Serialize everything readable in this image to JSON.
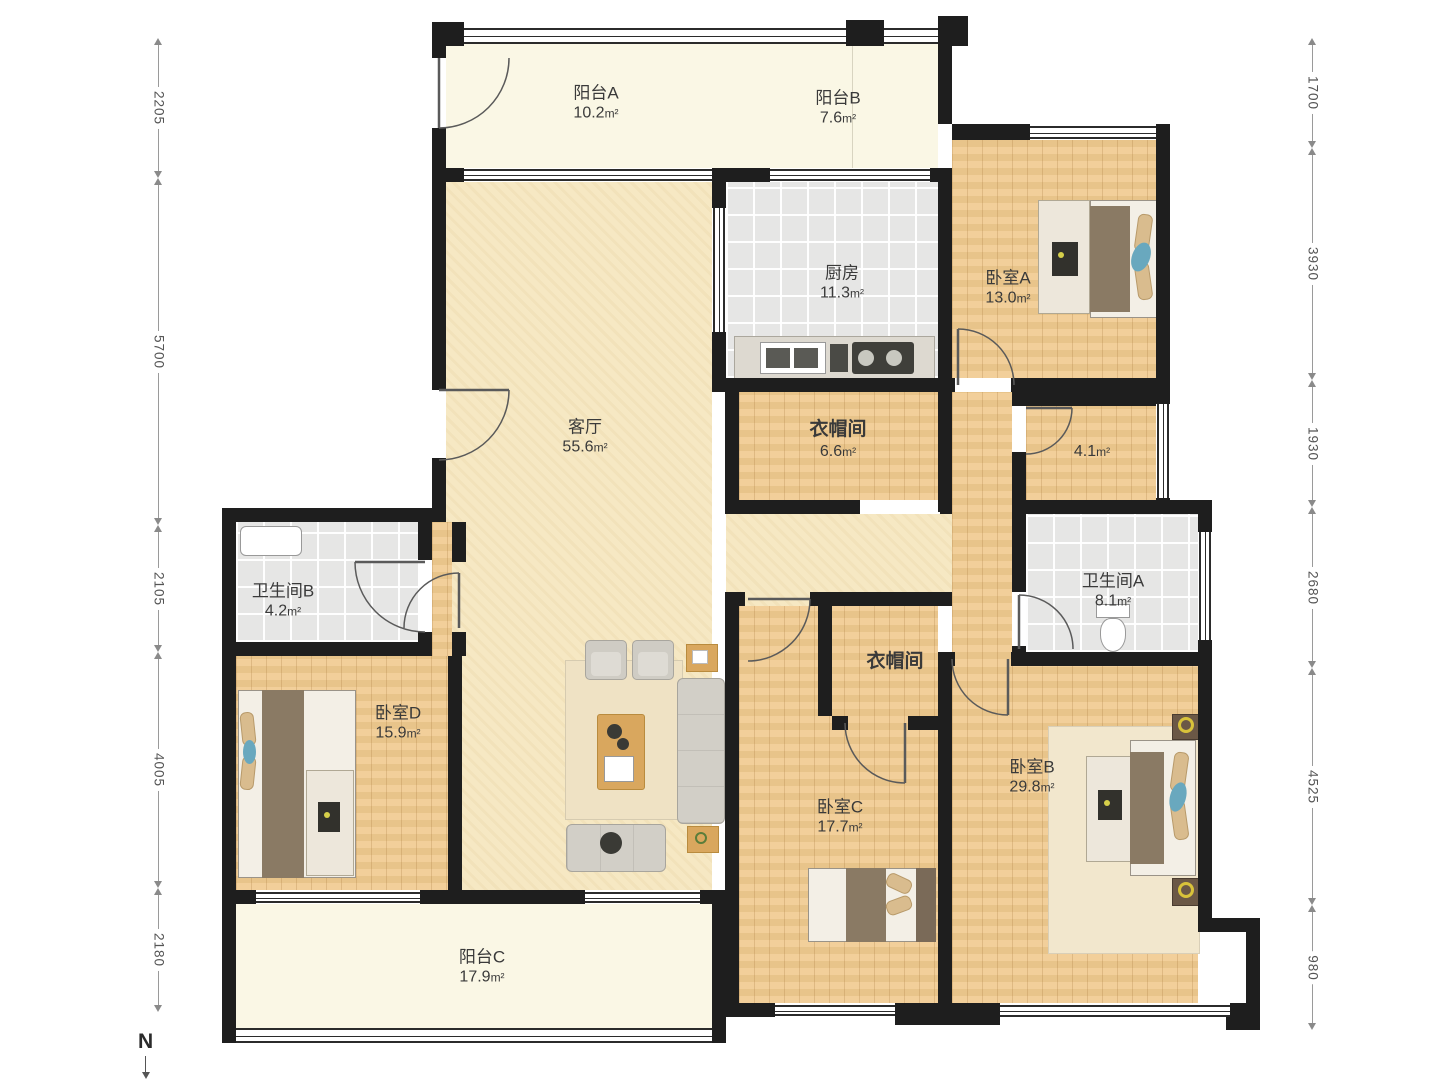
{
  "area_unit": "m²",
  "compass": {
    "label": "N"
  },
  "rooms": {
    "balconyA": {
      "name": "阳台A",
      "area": "10.2"
    },
    "balconyB": {
      "name": "阳台B",
      "area": "7.6"
    },
    "kitchen": {
      "name": "厨房",
      "area": "11.3"
    },
    "bedroomA": {
      "name": "卧室A",
      "area": "13.0"
    },
    "living": {
      "name": "客厅",
      "area": "55.6"
    },
    "cloak1": {
      "name": "衣帽间",
      "area": "6.6"
    },
    "storage": {
      "name": "",
      "area": "4.1"
    },
    "bathB": {
      "name": "卫生间B",
      "area": "4.2"
    },
    "bathA": {
      "name": "卫生间A",
      "area": "8.1"
    },
    "cloak2": {
      "name": "衣帽间",
      "area": ""
    },
    "bedroomD": {
      "name": "卧室D",
      "area": "15.9"
    },
    "bedroomC": {
      "name": "卧室C",
      "area": "17.7"
    },
    "bedroomB": {
      "name": "卧室B",
      "area": "29.8"
    },
    "balconyC": {
      "name": "阳台C",
      "area": "17.9"
    }
  },
  "dimensions": {
    "left": [
      "2205",
      "5700",
      "2105",
      "4005",
      "2180"
    ],
    "right": [
      "1700",
      "3930",
      "1930",
      "2680",
      "4525",
      "980"
    ]
  }
}
